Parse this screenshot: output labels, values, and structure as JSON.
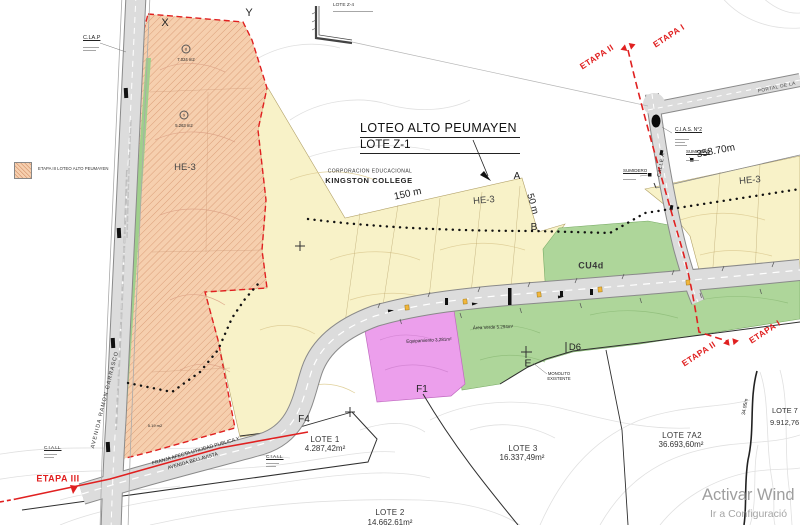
{
  "colors": {
    "pink": "#f6cfae",
    "pink_hatch": "#d89a74",
    "yellow": "#f8f2c8",
    "green": "#aed69a",
    "green_strip": "#9fcf8c",
    "magenta": "#ec9fec",
    "red": "#e02020",
    "road_fill": "#dcdcdc",
    "road_edge": "#8a8a8a"
  },
  "title": {
    "line1": "LOTEO ALTO PEUMAYEN",
    "line2": "LOTE Z-1"
  },
  "legend": {
    "label": "ETAPA III LOTEO ALTO PEUMAYEN"
  },
  "landowner": {
    "line1": "CORPORACION EDUCACIONAL",
    "line2": "KINGSTON COLLEGE"
  },
  "zones": {
    "he3": "HE-3",
    "cu4d": "CU4d",
    "equipamiento": "Equipamiento 3.281m²",
    "area_verde": "Área Verde 5.294m²"
  },
  "stages": {
    "etapa1": "ETAPA I",
    "etapa2": "ETAPA II",
    "etapa3": "ETAPA III"
  },
  "roads": {
    "avenida": "AVENIDA RAMON CARRASCO",
    "franja_line1": "FRANJA AFECTA UTILIDAD PUBLICA Y",
    "franja_line2": "AVENIDA BELLAVISTA",
    "calle_a": "CALLE A",
    "portal": "PORTAL DE LA"
  },
  "dimensions": {
    "d150": "150 m",
    "d50": "50 m",
    "d358": "358.70m",
    "d3495": "34.95m"
  },
  "markers": {
    "a": "A",
    "b": "B",
    "e": "E",
    "x": "X",
    "y": "Y",
    "f1": "F1",
    "f4": "F4",
    "d6": "D6"
  },
  "annotations": {
    "clap": "C.LA.P",
    "cias": "C.I.A.S. N°2",
    "sumidero": "SUMIDERO",
    "monolito_line1": "MONOLITO",
    "monolito_line2": "EXISTENTE",
    "ciall": "C.I.A.LL.",
    "lote_z4": "LOTE Z-4"
  },
  "parcels": {
    "n8": "8",
    "a8": "7.024 m2",
    "n9": "9",
    "a9": "5.263 m2",
    "a5": "5.19 m2"
  },
  "lots": [
    {
      "name": "LOTE 1",
      "area": "4.287,42m²"
    },
    {
      "name": "LOTE 2",
      "area": "14.662,61m²"
    },
    {
      "name": "LOTE 3",
      "area": "16.337,49m²"
    },
    {
      "name": "LOTE 7A2",
      "area": "36.693,60m²"
    },
    {
      "name": "LOTE 7",
      "area": "9.912,76"
    }
  ],
  "watermark": {
    "line1": "Activar Wind",
    "line2": "Ir a Configuració"
  }
}
